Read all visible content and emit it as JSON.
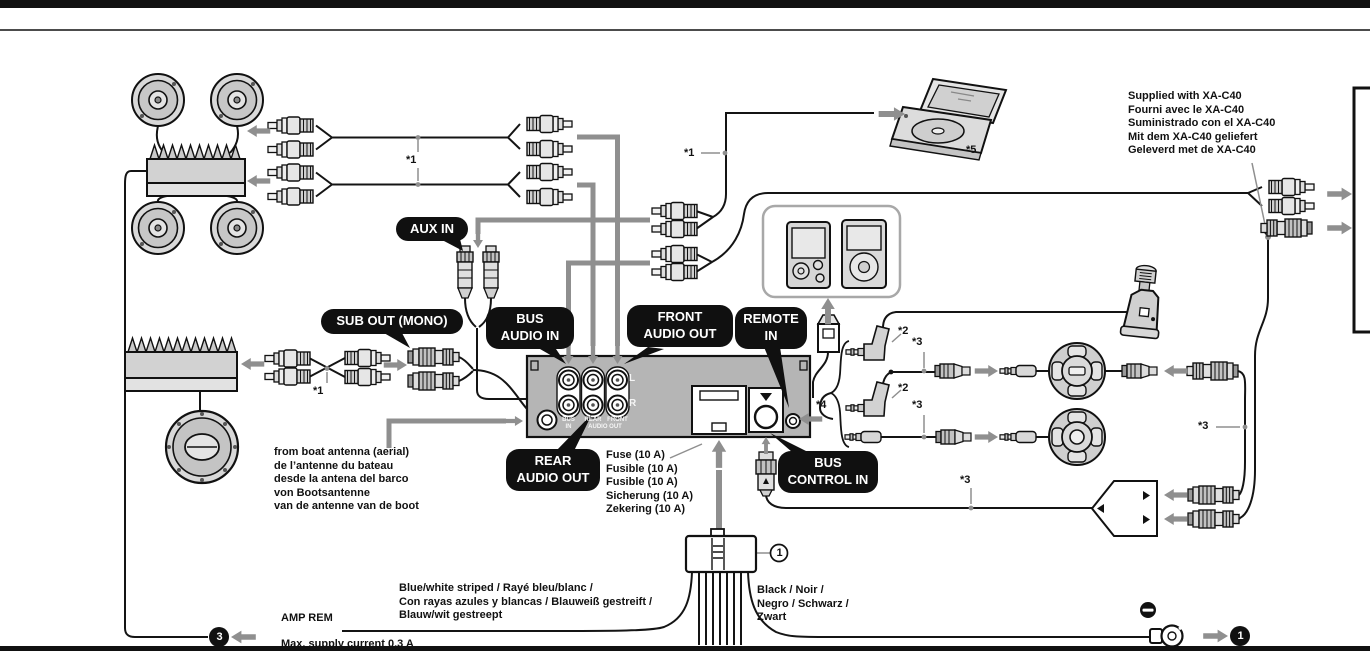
{
  "diagram": {
    "kind": "audio-system-wiring-connection-diagram"
  },
  "callouts": {
    "aux_in": "AUX IN",
    "sub_out_mono": "SUB OUT (MONO)",
    "bus_audio_in": "BUS\nAUDIO IN",
    "front_audio_out": "FRONT\nAUDIO OUT",
    "remote_in": "REMOTE\nIN",
    "rear_audio_out": "REAR\nAUDIO OUT",
    "bus_control_in": "BUS\nCONTROL IN"
  },
  "rear_panel": {
    "channel_left": "L",
    "channel_right": "R",
    "jack_label_bus": "BUS",
    "jack_label_rear": "REAR",
    "jack_label_front": "FRONT",
    "jack_label_in": "IN",
    "jack_label_audio_out": "AUDIO OUT"
  },
  "notes": {
    "supplied_with_xa_c40": [
      "Supplied with XA-C40",
      "Fourni avec le XA-C40",
      "Suministrado con el XA-C40",
      "Mit dem XA-C40 geliefert",
      "Geleverd met de XA-C40"
    ],
    "boat_antenna": [
      "from boat antenna (aerial)",
      "de l’antenne du bateau",
      "desde la antena del barco",
      "von Bootsantenne",
      "van de antenne van de boot"
    ],
    "fuse": [
      "Fuse (10 A)",
      "Fusible (10 A)",
      "Fusible (10 A)",
      "Sicherung (10 A)",
      "Zekering (10 A)"
    ],
    "blue_white_wire": [
      "Blue/white striped / Rayé bleu/blanc /",
      "Con rayas azules y blancas / Blauweiß gestreift /",
      "Blauw/wit gestreept"
    ],
    "amp_rem": "AMP REM",
    "max_supply_current": "Max. supply current 0.3 A",
    "black_wire": [
      "Black / Noir /",
      "Negro / Schwarz /",
      "Zwart"
    ]
  },
  "markers": {
    "note1": "*1",
    "note2": "*2",
    "note3": "*3",
    "note4": "*4",
    "note5": "*5"
  },
  "references": {
    "power_connector": "1",
    "ground_lead": "1",
    "amp_remote_lead": "3"
  },
  "colors": {
    "callout_bg": "#101010",
    "callout_text": "#ffffff",
    "cable_gray": "#8f8f8f",
    "line_black": "#141414"
  }
}
